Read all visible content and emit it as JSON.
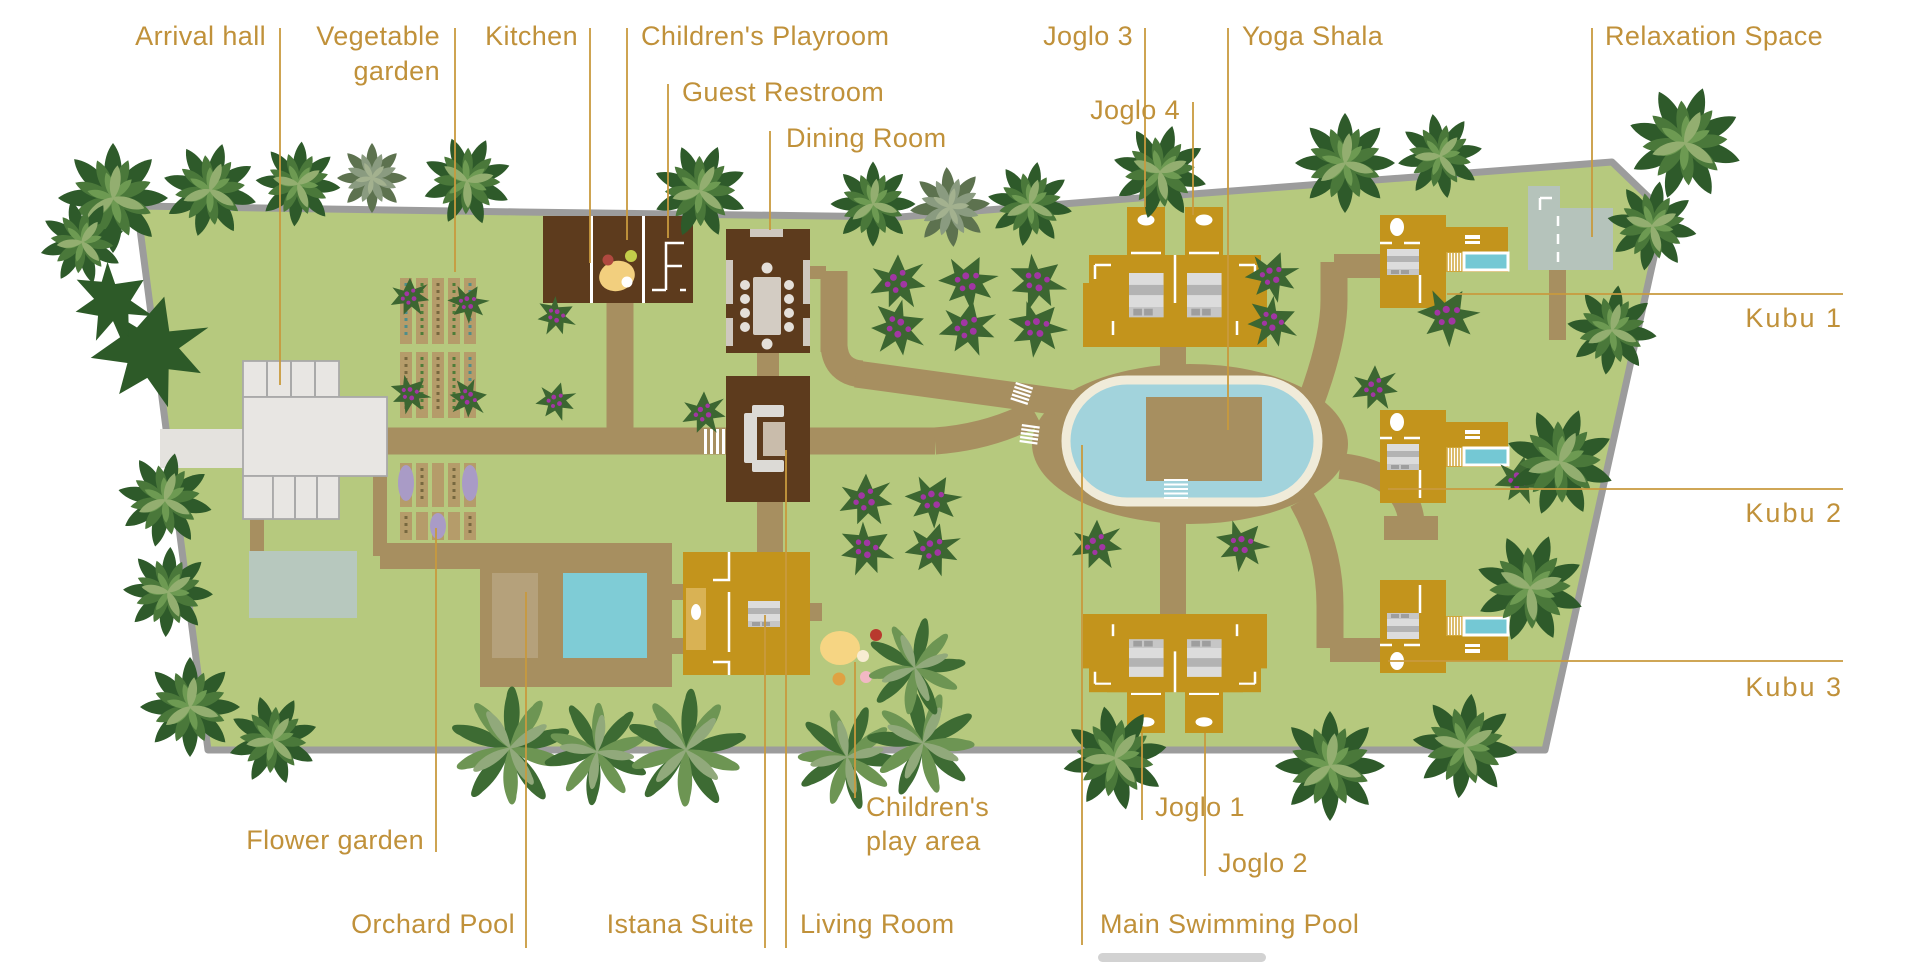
{
  "labels": {
    "arrival_hall": "Arrival hall",
    "vegetable_garden_1": "Vegetable",
    "vegetable_garden_2": "garden",
    "kitchen": "Kitchen",
    "childrens_playroom": "Children's Playroom",
    "guest_restroom": "Guest Restroom",
    "dining_room": "Dining Room",
    "joglo_3": "Joglo 3",
    "joglo_4": "Joglo 4",
    "yoga_shala": "Yoga Shala",
    "relaxation_space": "Relaxation Space",
    "kubu_1": "Kubu 1",
    "kubu_2": "Kubu 2",
    "kubu_3": "Kubu 3",
    "flower_garden": "Flower garden",
    "orchard_pool": "Orchard Pool",
    "istana_suite": "Istana Suite",
    "living_room": "Living Room",
    "play_area_1": "Children's",
    "play_area_2": "play area",
    "joglo_1": "Joglo 1",
    "joglo_2": "Joglo 2",
    "main_swimming_pool": "Main Swimming Pool"
  },
  "palette": {
    "label_gold": "#c0913a",
    "leader_line": "#c89a3e",
    "land_green": "#b6c97e",
    "boundary_gray": "#9c9c9c",
    "path_brown": "#a78f60",
    "building_dark_brown": "#5d3b1d",
    "building_gold": "#c3941c",
    "building_gold_light": "#d9b254",
    "building_white": "#e8e6e3",
    "entrance_road": "#e4e2de",
    "pool_water": "#a2d3dc",
    "pool_rim": "#f0ebd9",
    "plunge_pool": "#74c8d4",
    "orchard_pool_water": "#7fccd6",
    "pond_teal": "#b7c8be",
    "relaxation_gray": "#b5c3bb",
    "garden_bed_tan": "#b59c6a",
    "tree_green_dark": "#2e5a2a",
    "tree_green_mid": "#4a783a",
    "tree_green_light": "#6d9a52",
    "flower_purple": "#a136a3",
    "play_blob_yellow": "#f6d583"
  }
}
